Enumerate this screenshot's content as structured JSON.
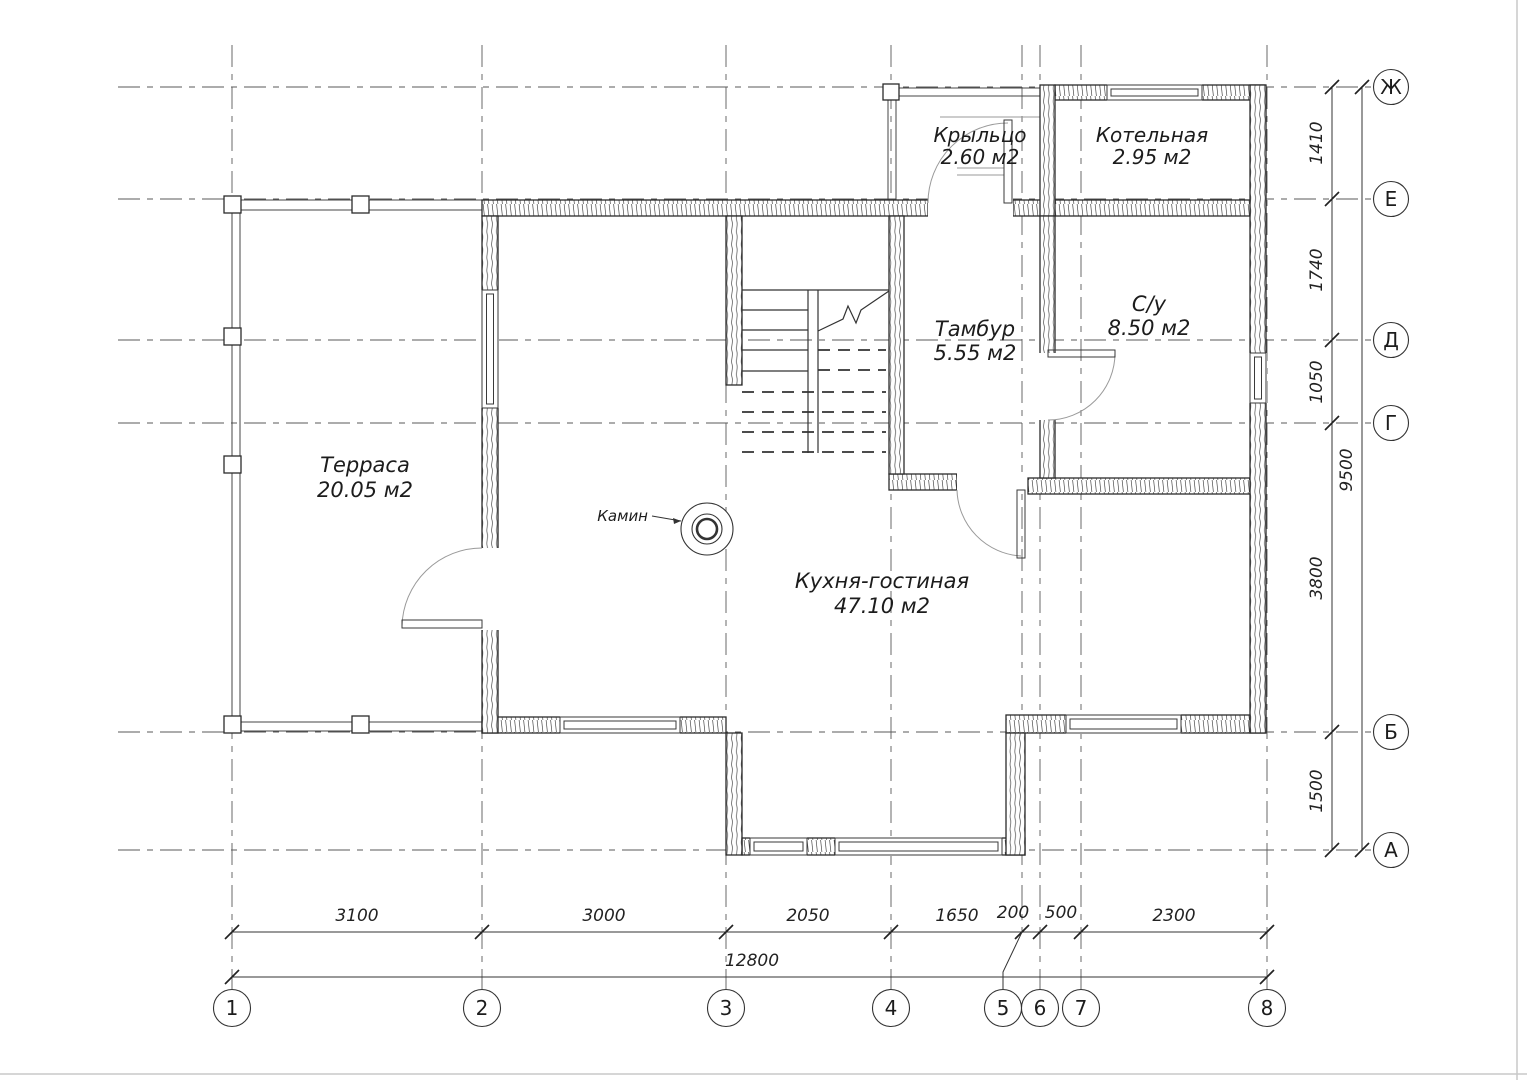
{
  "drawing": {
    "rooms": {
      "terrace": {
        "name": "Терраса",
        "area": "20.05 м2"
      },
      "kitchen": {
        "name": "Кухня-гостиная",
        "area": "47.10 м2"
      },
      "tambour": {
        "name": "Тамбур",
        "area": "5.55 м2"
      },
      "bathroom": {
        "name": "С/у",
        "area": "8.50 м2"
      },
      "porch": {
        "name": "Крыльцо",
        "area": "2.60 м2"
      },
      "boiler": {
        "name": "Котельная",
        "area": "2.95 м2"
      }
    },
    "fireplace_label": "Камин",
    "axes": {
      "columns": [
        "1",
        "2",
        "3",
        "4",
        "5",
        "6",
        "7",
        "8"
      ],
      "rows": [
        "Ж",
        "Е",
        "Д",
        "Г",
        "Б",
        "А"
      ]
    },
    "dims": {
      "bottom": [
        "3100",
        "3000",
        "2050",
        "1650",
        "200",
        "500",
        "2300"
      ],
      "bottom_total": "12800",
      "right": [
        "1410",
        "1740",
        "1050",
        "3800",
        "1500"
      ],
      "right_total": "9500"
    },
    "colors": {
      "line": "#2b2b2b",
      "grid": "#5a5a5a",
      "background": "#ffffff"
    }
  }
}
